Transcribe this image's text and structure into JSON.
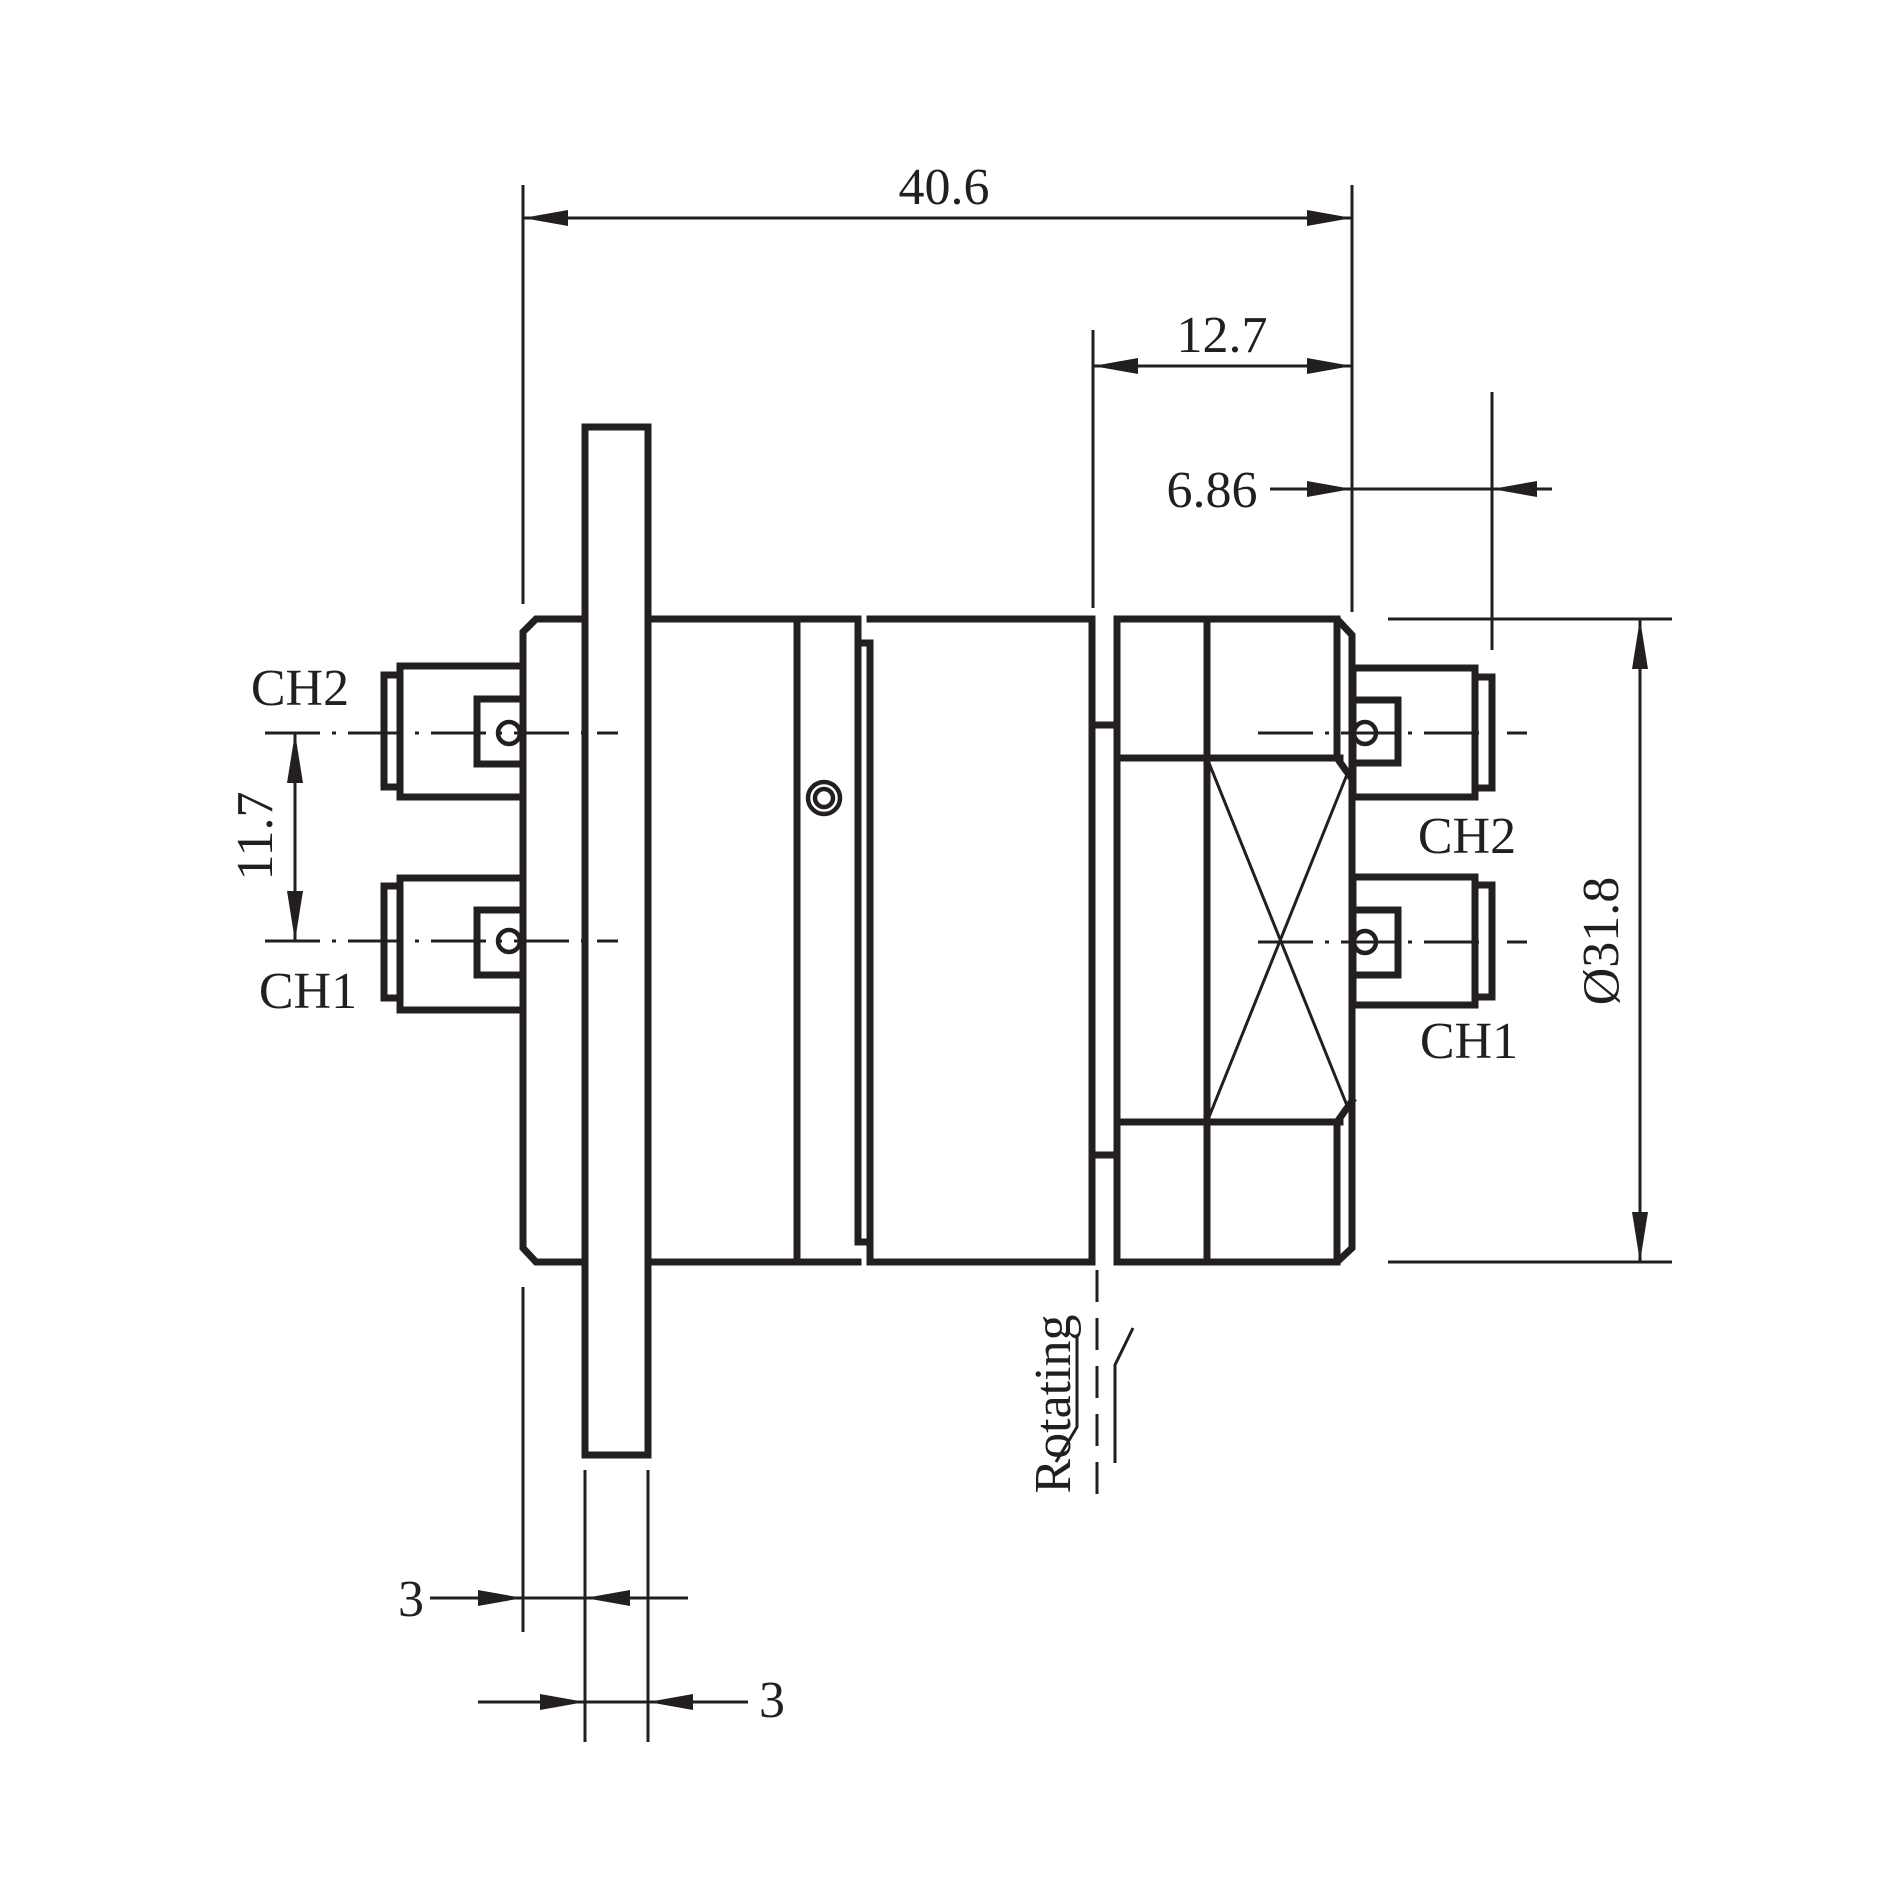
{
  "meta": {
    "ink_color": "#231f20",
    "background_color": "#ffffff"
  },
  "dimensions": {
    "overall_length": "40.6",
    "stator_length": "12.7",
    "connector_offset": "6.86",
    "channel_spacing": "11.7",
    "body_diameter": "Ø31.8",
    "hub_lip_thickness": "3",
    "plate_thickness": "3"
  },
  "connector_labels": {
    "left_ch2": "CH2",
    "left_ch1": "CH1",
    "right_ch2": "CH2",
    "right_ch1": "CH1"
  },
  "annotations": {
    "rotating": "Rotating"
  }
}
